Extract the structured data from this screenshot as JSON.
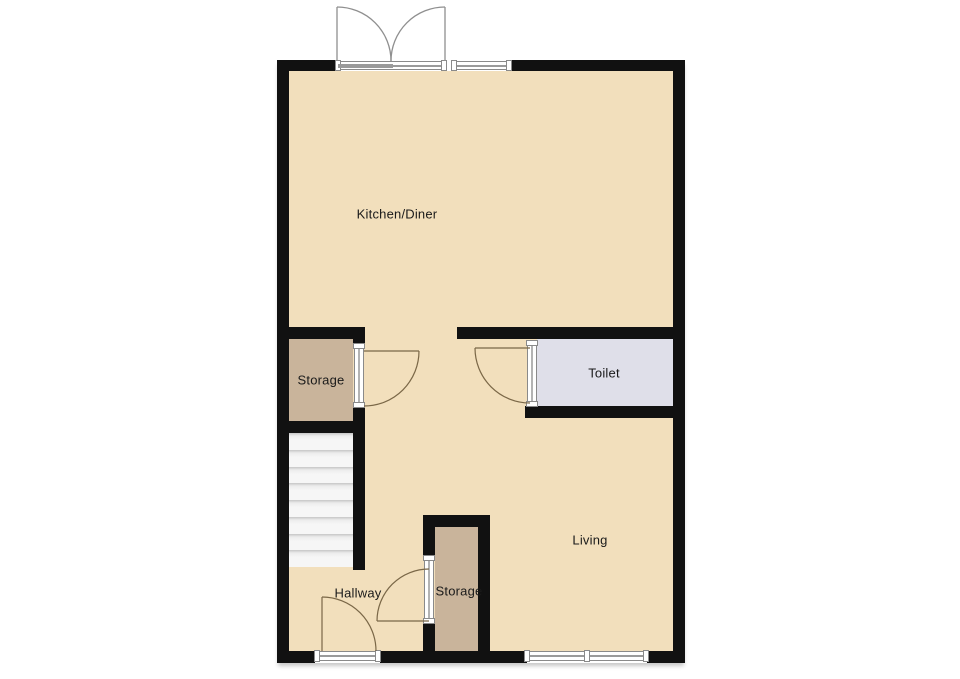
{
  "floorplan": {
    "rooms": [
      {
        "id": "kitchen-diner",
        "label": "Kitchen/Diner"
      },
      {
        "id": "storage-upper",
        "label": "Storage"
      },
      {
        "id": "toilet",
        "label": "Toilet"
      },
      {
        "id": "living",
        "label": "Living"
      },
      {
        "id": "hallway",
        "label": "Hallway"
      },
      {
        "id": "storage-lower",
        "label": "Storage"
      }
    ],
    "stairs": {
      "treads": 8
    },
    "colors": {
      "wall": "#111111",
      "main_floor": "#F2DFBC",
      "storage_floor": "#C9B49B",
      "toilet_floor": "#DFDFE9",
      "stairs_floor": "#F6F6F6",
      "door_swing": "#7A6747",
      "entry_door_swing": "#8F8F8F",
      "label_text": "#1A1A1A"
    }
  }
}
